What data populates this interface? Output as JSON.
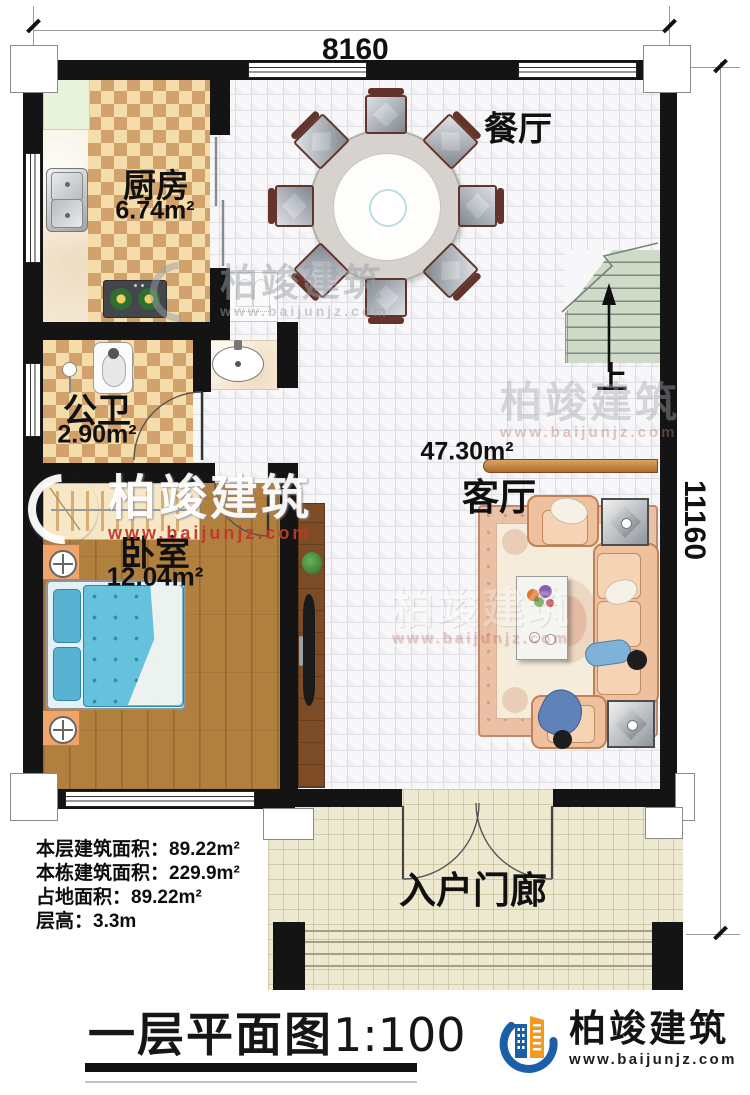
{
  "dims": {
    "width": "8160",
    "height": "11160"
  },
  "rooms": {
    "kitchen": {
      "name": "厨房",
      "area": "6.74m²"
    },
    "dining": {
      "name": "餐厅"
    },
    "bath": {
      "name": "公卫",
      "area": "2.90m²"
    },
    "bedroom": {
      "name": "卧室",
      "area": "12.04m²"
    },
    "living": {
      "name": "客厅",
      "area": "47.30m²"
    },
    "porch": {
      "name": "入户门廊"
    },
    "stairs": {
      "up": "上"
    }
  },
  "info": {
    "line1": "本层建筑面积：89.22m²",
    "line2": "本栋建筑面积：229.9m²",
    "line3": "占地面积：89.22m²",
    "line4": "层高：3.3m"
  },
  "footer": {
    "plan_title": "一层平面图",
    "scale": "1:100"
  },
  "brand": {
    "name": "柏竣建筑",
    "site": "www.baijunjz.com"
  },
  "watermark": {
    "name": "柏竣建筑",
    "site": "www.baijunjz.com"
  },
  "colors": {
    "wall": "#141414",
    "accent_blue": "#1a5fa8",
    "accent_orange": "#f29a1d",
    "wm_red": "#c0392b"
  }
}
